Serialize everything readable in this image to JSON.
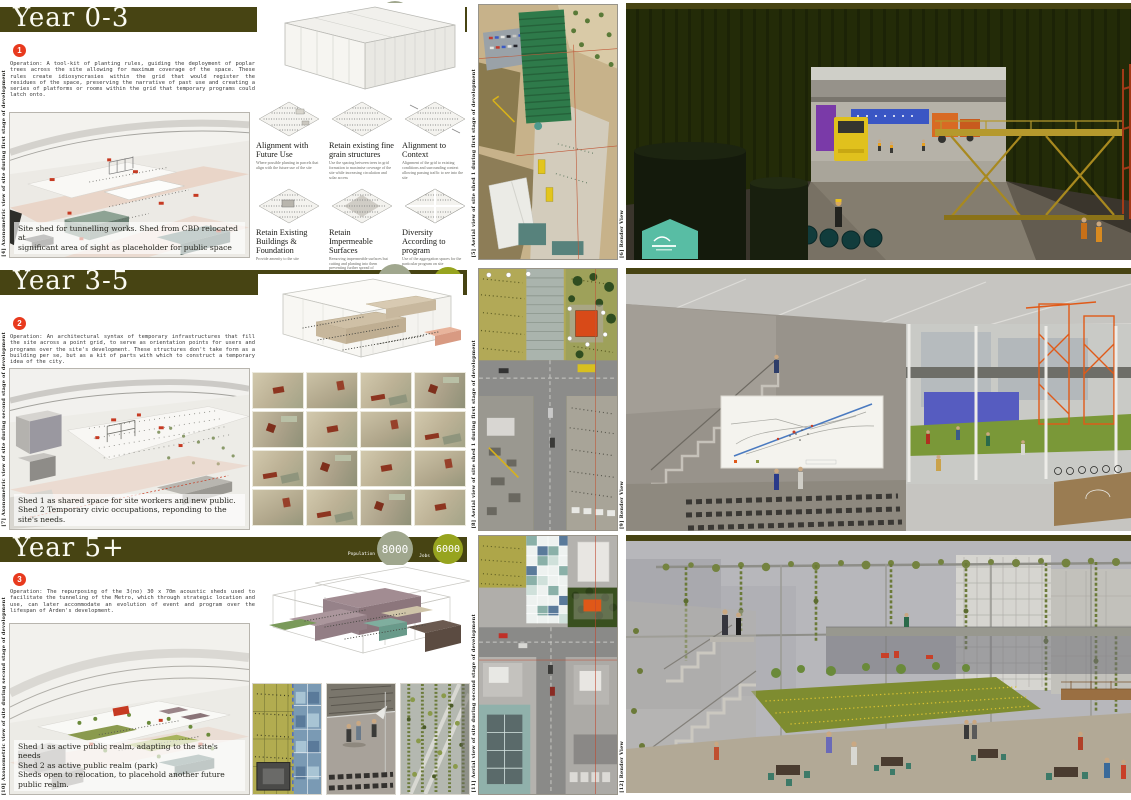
{
  "colors": {
    "header_olive": "#474413",
    "population_circle": "#a0a78e",
    "jobs_circle": "#97a41f",
    "step_red": "#e83a1e"
  },
  "sections": [
    {
      "title": "Year 0-3",
      "stats": {
        "population_label": "Population",
        "population": "1000",
        "jobs_label": "Jobs",
        "jobs": "600"
      },
      "step": "1",
      "operation": "Operation: A tool-kit of planting rules, guiding the deployment of poplar trees across the site allowing for maximum coverage of the space. These rules create idiosyncrasies within the grid that would register the residues of the space, preserving the narrative of past use and creating a series of platforms or rooms within the grid that temporary programs could latch onto.",
      "caption_lines": [
        "Site shed for tunnelling works. Shed from CBD relocated at",
        "significant  area of sight as placeholder for public space"
      ],
      "axon_side_label": "[4] Axonometric view of site during first stage of development",
      "aerial_side_label": "[5] Aerial view of site shed 1 during first stage of development",
      "render_side_label": "[6] Render View",
      "strategies": [
        {
          "title": "Alignment with Future Use",
          "desc": "Where possible planting in parcels that align with the future use of the site"
        },
        {
          "title": "Retain existing fine grain structures",
          "desc": "Use the spacing between trees in grid formation to maximise coverage of the site while increasing circulation and solar access"
        },
        {
          "title": "Alignment to Context",
          "desc": "Alignment of the grid to existing conditions and surrounding context allowing passing traffic to see into the site"
        },
        {
          "title": "Retain Existing Buildings & Foundation",
          "desc": "Provide amenity to the site"
        },
        {
          "title": "Retain Impermeable Surfaces",
          "desc": "Removing impermeable surfaces but cutting and planting into them preventing further spread of contamination through surface water and encouraging plants to soak up ground water"
        },
        {
          "title": "Diversity According to program",
          "desc": "Use of the aggregation spaces for the particular program on site"
        }
      ]
    },
    {
      "title": "Year 3-5",
      "stats": {
        "population_label": "Population",
        "population": "5500",
        "jobs_label": "Jobs",
        "jobs": "4000"
      },
      "step": "2",
      "operation": "Operation: An architectural syntax of temporary infrastructures that fill the site across a point grid, to serve as orientation points for users and programs over the site's development.  These structures don't take form as a building per se, but as a kit of parts with which to construct a temporary idea of the city.",
      "caption_lines": [
        "Shed 1 as shared space for site workers and new public.",
        "Shed 2 Temporary civic occupations, reponding to the site's needs."
      ],
      "axon_side_label": "[7] Axonometric view of site during second stage of development",
      "aerial_side_label": "[8] Aerial view of site shed 1 during first stage of development",
      "render_side_label": "[9] Render View"
    },
    {
      "title": "Year 5+",
      "stats": {
        "population_label": "Population",
        "population": "8000",
        "jobs_label": "Jobs",
        "jobs": "6000"
      },
      "step": "3",
      "operation": "Operation: The repurposing of the 3(no) 30 x 70m acoustic sheds used to facilitate the tunneling of the Metro, which through strategic location and use, can later accommodate an evolution of event and program over the lifespan of Arden's development.",
      "caption_lines": [
        "Shed 1 as active public realm, adapting to the site's needs",
        "Shed 2 as active public realm (park)",
        "Sheds open to relocation, to placehold another future public realm."
      ],
      "axon_side_label": "[10] Axonometric view of site during second stage of development",
      "aerial_side_label": "[11] Aerial view of site during second stage of development",
      "render_side_label": "[12] Render View"
    }
  ]
}
